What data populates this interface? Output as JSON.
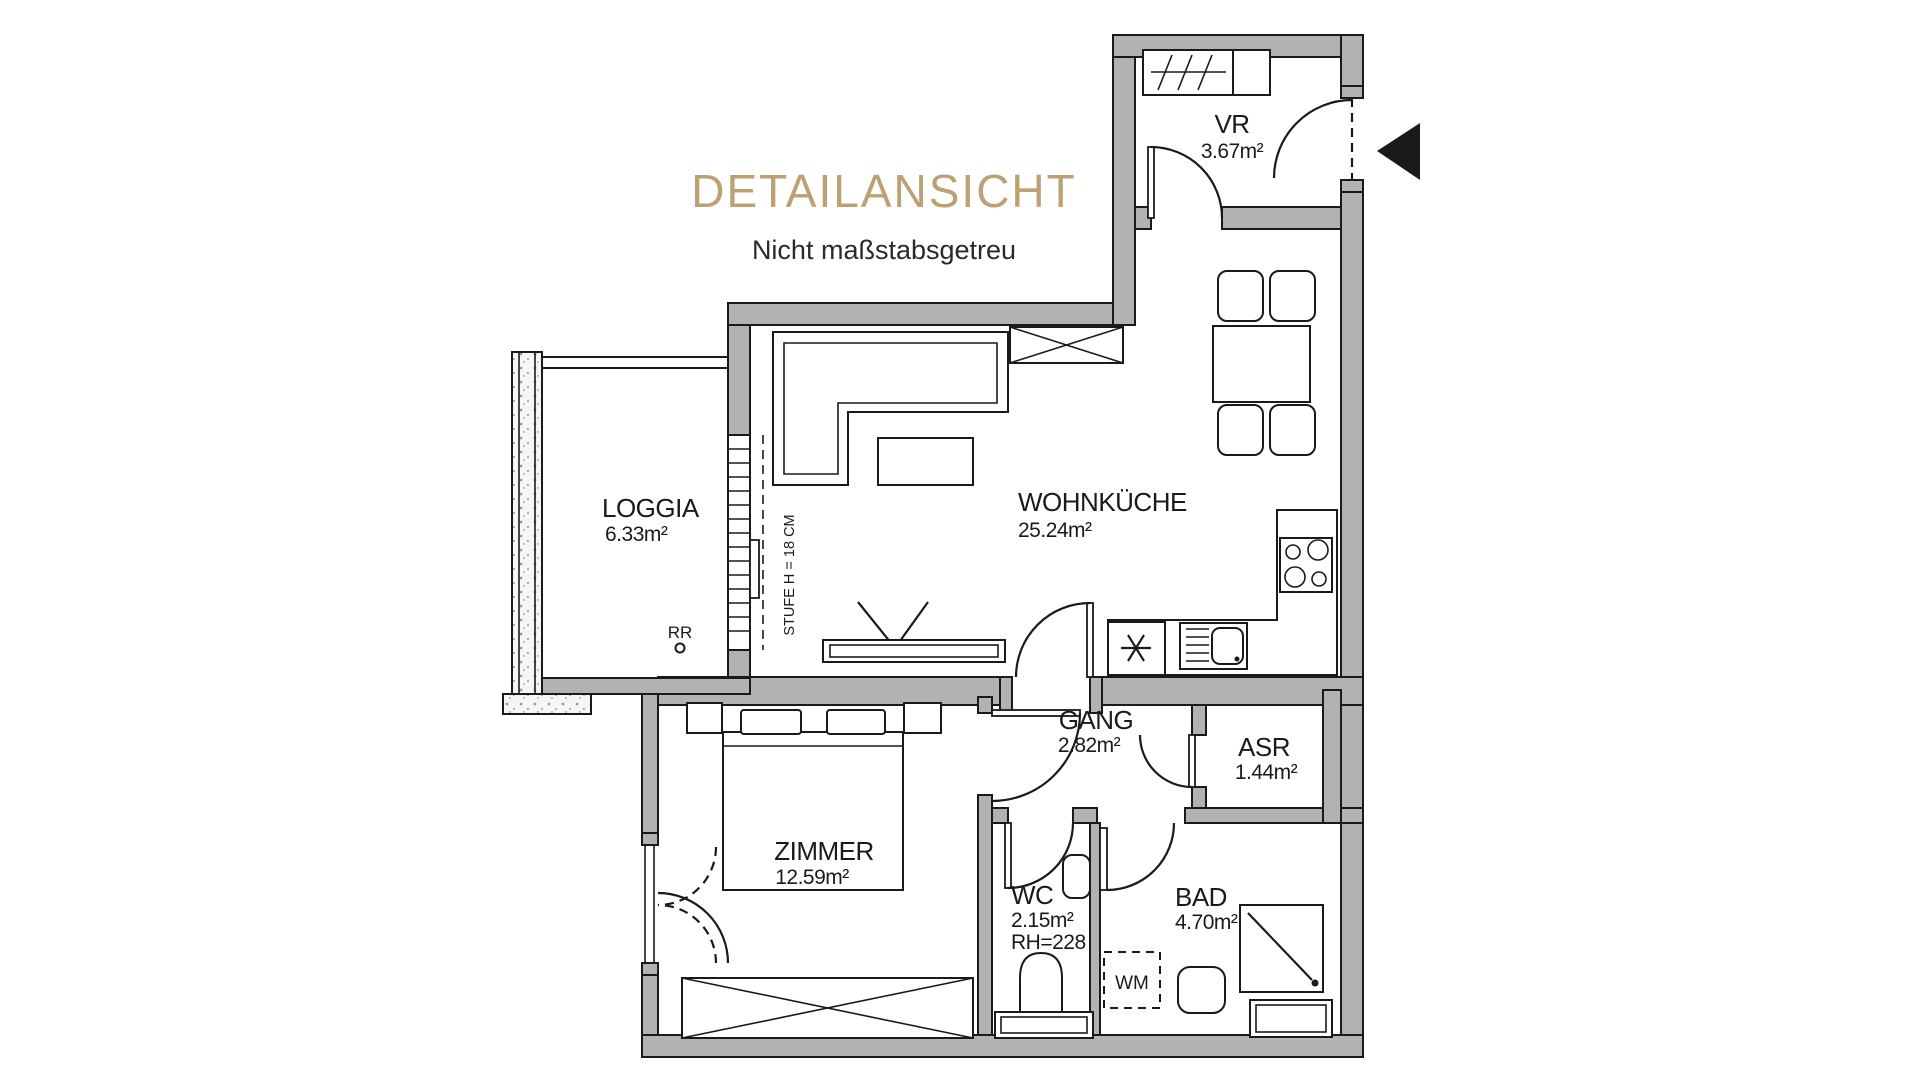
{
  "header": {
    "title": "DETAILANSICHT",
    "subtitle": "Nicht maßstabsgetreu"
  },
  "colors": {
    "accent_gold": "#bda173",
    "wall_gray": "#b2b2b2",
    "line_black": "#1a1a1a",
    "background": "#ffffff"
  },
  "rooms": {
    "vr": {
      "name": "VR",
      "area": "3.67m²"
    },
    "wohnkueche": {
      "name": "WOHNKÜCHE",
      "area": "25.24m²"
    },
    "loggia": {
      "name": "LOGGIA",
      "area": "6.33m²"
    },
    "gang": {
      "name": "GANG",
      "area": "2.82m²"
    },
    "asr": {
      "name": "ASR",
      "area": "1.44m²"
    },
    "zimmer": {
      "name": "ZIMMER",
      "area": "12.59m²"
    },
    "wc": {
      "name": "WC",
      "area": "2.15m²",
      "room_height": "RH=228"
    },
    "bad": {
      "name": "BAD",
      "area": "4.70m²"
    }
  },
  "annotations": {
    "step_note": "STUFE H = 18 CM",
    "rain_pipe": "RR",
    "washing_machine": "WM"
  }
}
